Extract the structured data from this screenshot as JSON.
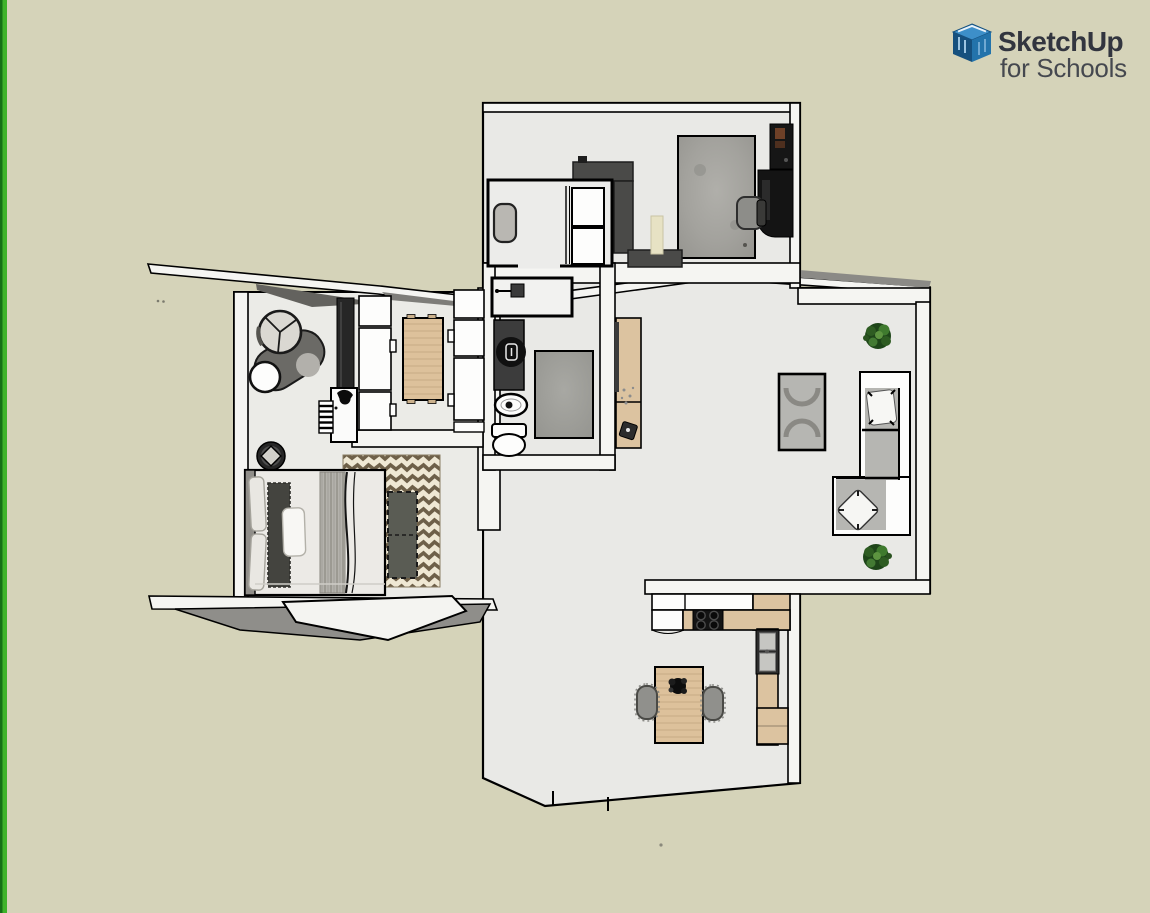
{
  "app": {
    "name": "SketchUp for Schools"
  },
  "logo": {
    "line1": "SketchUp",
    "line2": "for Schools"
  },
  "theme": {
    "bg": "#d5d3b9",
    "edge-green-dark": "#157015",
    "edge-green": "#3fb32a",
    "floor": "#e9e9e6",
    "floor-wing": "#ebebe7",
    "wall": "#f5f5f2",
    "outline": "#000000",
    "dark-furniture": "#474745",
    "counter-dark": "#4a4a48",
    "wood": "#dcc3a0",
    "wood-table": "#ddc19b",
    "rug-gray": "#a3a29d",
    "mat-gray": "#9b9b96",
    "sofa-gray": "#b6b6b2",
    "chevron-brown": "#6e6049",
    "chevron-cream": "#efe8d4",
    "plant-green": "#2e5c22",
    "logo-blue": "#2373ab",
    "logo-blue-dark": "#16507e",
    "logo-blue-light": "#3d8fc9",
    "logo-text": "#32353f",
    "logo-subtext": "#45484f"
  },
  "floor_plan": {
    "rooms": [
      "office",
      "closet",
      "bathroom",
      "dining-room",
      "bedroom",
      "living-room",
      "kitchen",
      "hallway"
    ],
    "furniture": [
      "office-rug",
      "bookshelf",
      "office-desk",
      "office-chair",
      "kitchenette-counter",
      "office-door",
      "closet-bench",
      "closet-cabinets",
      "shower",
      "bathroom-vanity",
      "vanity-basin",
      "bathroom-sink",
      "toilet",
      "bath-mat",
      "console-table",
      "coffee-table",
      "sectional-sofa",
      "sofa-pillow-top",
      "sofa-pillow-chaise",
      "potted-plant-north",
      "potted-plant-south",
      "kitchen-upper-cabinets",
      "kitchen-counter",
      "gas-stove",
      "kitchen-sink",
      "kitchen-lower-cabinet",
      "kitchen-dining-table",
      "table-centerpiece-plant",
      "kitchen-chair-left",
      "kitchen-chair-right",
      "dining-table-wood",
      "dining-chairs-left",
      "dining-chairs-right",
      "wardrobe",
      "bedroom-desk",
      "desk-chair",
      "radiator",
      "round-armchair",
      "side-table",
      "planter-pot",
      "bed",
      "bed-headboard",
      "bed-pillows",
      "bed-runner",
      "bed-blanket",
      "chevron-rug",
      "bench-ottoman"
    ]
  }
}
